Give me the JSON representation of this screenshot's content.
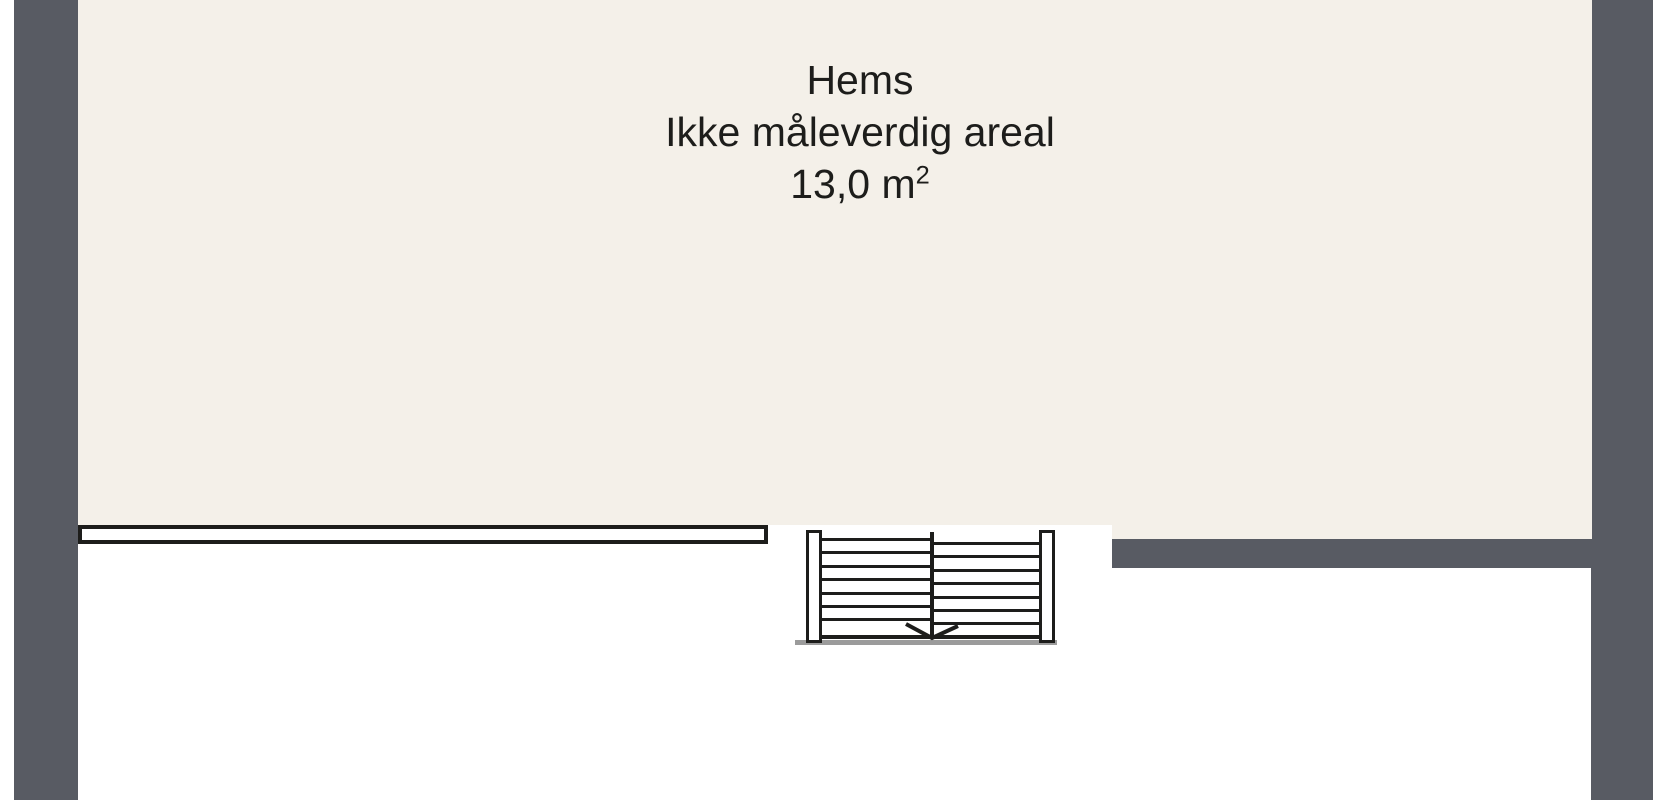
{
  "floorplan": {
    "room": {
      "name": "Hems",
      "note": "Ikke måleverdig areal",
      "area_value": "13,0 m",
      "area_exponent": "2"
    },
    "stair": {
      "treads_per_side": 7,
      "direction": "down",
      "arrow_icon": "down-arrow"
    },
    "colors": {
      "wall": "#585b63",
      "floor": "#f4f0e9",
      "line": "#1d1d1b",
      "shadow": "#9b9b9b",
      "background": "#ffffff"
    }
  }
}
